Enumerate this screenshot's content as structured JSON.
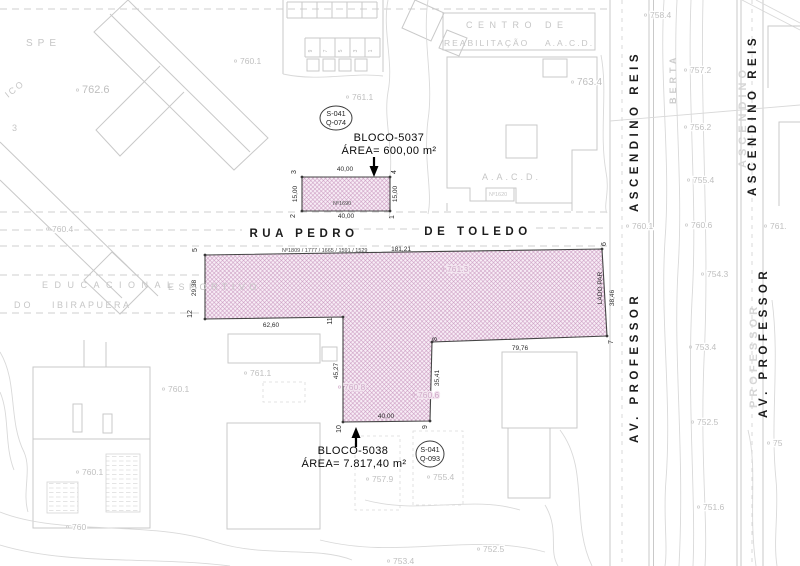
{
  "streets": {
    "rua_pedro": "RUA PEDRO",
    "de_toledo": "DE TOLEDO",
    "av_professor": "AV.  PROFESSOR",
    "ascendino_reis": "ASCENDINO  REIS",
    "ghost_ascendino": "ASCENDINO",
    "ghost_professor": "PROFESSOR",
    "berta": "BERTA"
  },
  "parcels": {
    "bloco5037": {
      "name": "BLOCO-5037",
      "area": "ÁREA= 600,00 m²",
      "house_number": "Nº1690",
      "plate_line1": "S-041",
      "plate_line2": "Q-074",
      "points": "302,177 390,177 390,211 302,211",
      "dimensions": [
        {
          "t": "40,00",
          "x": 345,
          "y": 171
        },
        {
          "t": "40,00",
          "x": 346,
          "y": 218
        },
        {
          "t": "15,00",
          "x": 297,
          "y": 194,
          "r": -90
        },
        {
          "t": "15,00",
          "x": 397,
          "y": 194,
          "r": -90
        }
      ],
      "vertices": [
        {
          "n": "3",
          "x": 296,
          "y": 172,
          "cx": 302,
          "cy": 177
        },
        {
          "n": "4",
          "x": 396,
          "y": 172,
          "cx": 390,
          "cy": 177
        },
        {
          "n": "2",
          "x": 295,
          "y": 216,
          "cx": 302,
          "cy": 211
        },
        {
          "n": "1",
          "x": 394,
          "y": 217,
          "cx": 390,
          "cy": 211
        }
      ]
    },
    "bloco5038": {
      "name": "BLOCO-5038",
      "area": "ÁREA= 7.817,40 m²",
      "street_numbers": "Nº1809 / 1777 / 1665 / 1591 / 1529",
      "side_label": "LADO PAR",
      "plate_line1": "S-041",
      "plate_line2": "Q-093",
      "points": "205,255 602,249 607,336 432,342 430,421 343,422 343,317 205,319",
      "dimensions": [
        {
          "t": "181,21",
          "x": 401,
          "y": 251
        },
        {
          "t": "29,38",
          "x": 196,
          "y": 288,
          "r": -90
        },
        {
          "t": "62,60",
          "x": 271,
          "y": 327
        },
        {
          "t": "45,27",
          "x": 338,
          "y": 371,
          "r": -90
        },
        {
          "t": "40,00",
          "x": 386,
          "y": 418
        },
        {
          "t": "35,41",
          "x": 439,
          "y": 378,
          "r": -90
        },
        {
          "t": "79,76",
          "x": 520,
          "y": 350
        },
        {
          "t": "38,46",
          "x": 614,
          "y": 298,
          "r": -90
        }
      ],
      "vertices": [
        {
          "n": "5",
          "x": 197,
          "y": 250,
          "cx": 205,
          "cy": 255
        },
        {
          "n": "6",
          "x": 606,
          "y": 244,
          "cx": 602,
          "cy": 249
        },
        {
          "n": "7",
          "x": 613,
          "y": 342,
          "cx": 607,
          "cy": 336
        },
        {
          "n": "8",
          "x": 437,
          "y": 339,
          "cx": 432,
          "cy": 342
        },
        {
          "n": "9",
          "x": 427,
          "y": 427,
          "cx": 430,
          "cy": 421
        },
        {
          "n": "10",
          "x": 341,
          "y": 429,
          "cx": 343,
          "cy": 422
        },
        {
          "n": "11",
          "x": 332,
          "y": 321,
          "cx": 343,
          "cy": 317
        },
        {
          "n": "12",
          "x": 192,
          "y": 314,
          "cx": 205,
          "cy": 319
        }
      ]
    }
  },
  "background": {
    "lot_numbers": [
      {
        "t": "9",
        "x": 312,
        "y": 51
      },
      {
        "t": "7",
        "x": 327,
        "y": 51
      },
      {
        "t": "5",
        "x": 342,
        "y": 51
      },
      {
        "t": "3",
        "x": 357,
        "y": 51
      },
      {
        "t": "1",
        "x": 372,
        "y": 51
      }
    ],
    "area_labels": [
      {
        "t": "SPE",
        "x": 26,
        "y": 46,
        "fs": 10,
        "ls": 5
      },
      {
        "t": "ICO",
        "x": 8,
        "y": 98,
        "fs": 9,
        "ls": 2,
        "r": -38
      },
      {
        "t": "3",
        "x": 12,
        "y": 131,
        "fs": 9,
        "ls": 0
      },
      {
        "t": "CENTRO DE",
        "x": 466,
        "y": 28,
        "fs": 9,
        "ls": 5.5
      },
      {
        "t": "REABILITAÇÃO",
        "x": 444,
        "y": 46,
        "fs": 8.5,
        "ls": 2
      },
      {
        "t": "A.A.C.D.",
        "x": 545,
        "y": 46,
        "fs": 8.5,
        "ls": 2
      },
      {
        "t": "A.A.C.D.",
        "x": 482,
        "y": 180,
        "fs": 9,
        "ls": 3
      },
      {
        "t": "Nº1620",
        "x": 489,
        "y": 196,
        "fs": 5.5,
        "ls": 0,
        "c": "#b0b0b0"
      },
      {
        "t": "EDUCACIONAL",
        "x": 42,
        "y": 288,
        "fs": 9,
        "ls": 6.5
      },
      {
        "t": "DO",
        "x": 14,
        "y": 308,
        "fs": 9,
        "ls": 3
      },
      {
        "t": "IBIRAPUERA",
        "x": 52,
        "y": 308,
        "fs": 9,
        "ls": 2.5
      },
      {
        "t": "ESPORTIVO",
        "x": 168,
        "y": 290,
        "fs": 9,
        "ls": 4.5,
        "pink": true
      }
    ],
    "elevations": [
      {
        "t": "760.1",
        "x": 240,
        "y": 64
      },
      {
        "t": "761.1",
        "x": 352,
        "y": 100
      },
      {
        "t": "762.6",
        "x": 82,
        "y": 93,
        "fs": 11
      },
      {
        "t": "763.4",
        "x": 577,
        "y": 85,
        "fs": 10
      },
      {
        "t": "758.4",
        "x": 650,
        "y": 18
      },
      {
        "t": "757.2",
        "x": 690,
        "y": 73
      },
      {
        "t": "756.2",
        "x": 690,
        "y": 130
      },
      {
        "t": "755.4",
        "x": 693,
        "y": 183
      },
      {
        "t": "760.1",
        "x": 632,
        "y": 229
      },
      {
        "t": "760.6",
        "x": 691,
        "y": 228
      },
      {
        "t": "761.",
        "x": 770,
        "y": 229
      },
      {
        "t": "754.3",
        "x": 707,
        "y": 277
      },
      {
        "t": "753.4",
        "x": 695,
        "y": 350
      },
      {
        "t": "752.5",
        "x": 697,
        "y": 425
      },
      {
        "t": "751.6",
        "x": 703,
        "y": 510
      },
      {
        "t": "75",
        "x": 773,
        "y": 446
      },
      {
        "t": "760.4",
        "x": 52,
        "y": 232
      },
      {
        "t": "761.3",
        "x": 447,
        "y": 272,
        "pink": true
      },
      {
        "t": "761.1",
        "x": 250,
        "y": 376
      },
      {
        "t": "760.1",
        "x": 168,
        "y": 392
      },
      {
        "t": "760.8",
        "x": 344,
        "y": 390,
        "pink": true
      },
      {
        "t": "760.6",
        "x": 418,
        "y": 398,
        "pink": true
      },
      {
        "t": "757.9",
        "x": 372,
        "y": 482
      },
      {
        "t": "755.4",
        "x": 433,
        "y": 480
      },
      {
        "t": "760.1",
        "x": 82,
        "y": 475
      },
      {
        "t": "760",
        "x": 72,
        "y": 530
      },
      {
        "t": "752.5",
        "x": 483,
        "y": 552
      },
      {
        "t": "753.4",
        "x": 393,
        "y": 564
      }
    ]
  }
}
